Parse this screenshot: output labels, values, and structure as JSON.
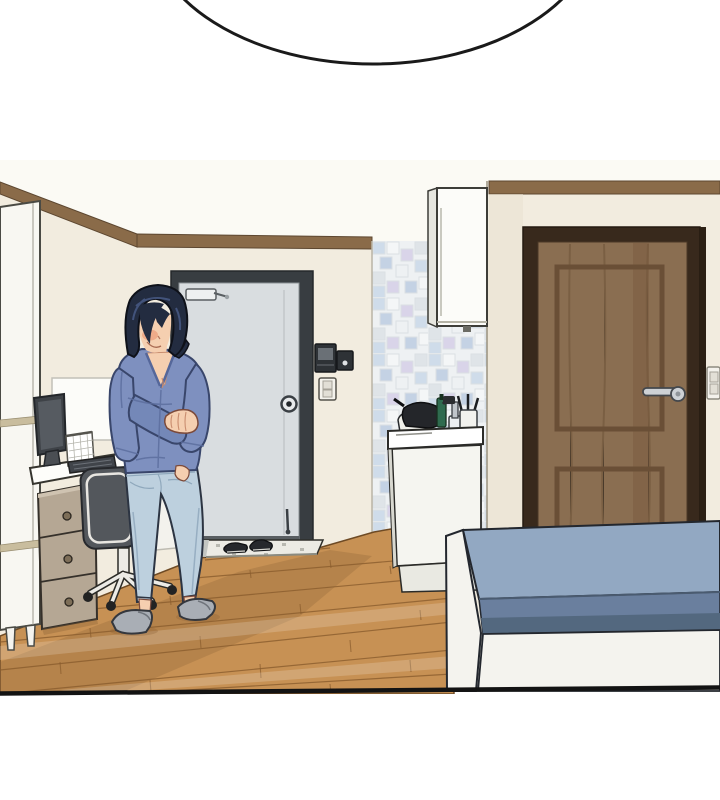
{
  "scene": {
    "kind": "webtoon-comic-panel",
    "speech_bubble": {
      "present": true,
      "text": ""
    },
    "objects": [
      "speech-bubble",
      "ceiling-trim",
      "left-wardrobe",
      "desk",
      "computer-monitor",
      "keyboard",
      "desk-calendar",
      "drawer-unit",
      "office-chair",
      "woman-figure",
      "entry-door",
      "door-closer",
      "door-peephole",
      "intercom-unit",
      "light-switch",
      "entry-step",
      "shoes",
      "tile-backsplash",
      "wall-cabinet",
      "sink-unit",
      "faucet",
      "dishes",
      "brown-door",
      "door-lever-handle",
      "right-light-switch",
      "bed",
      "mattress",
      "wood-floor",
      "panel-border"
    ]
  },
  "colors": {
    "page_bg": "#ffffff",
    "bubble_fill": "#ffffff",
    "bubble_stroke": "#1a1a1a",
    "ceiling": "#fbfaf4",
    "wall": "#f2ecdf",
    "wall_shade": "#e9e1d0",
    "trim_wood": "#8a6b49",
    "wardrobe_white": "#f8f7f2",
    "wardrobe_trim": "#c9bd9e",
    "panel_white": "#fcfcf9",
    "desk_white": "#fdfdfa",
    "monitor_dark": "#3e4247",
    "screen_gray": "#565b61",
    "keyboard_dark": "#40444a",
    "drawer_taupe": "#b5a794",
    "knob_brown": "#7d6e58",
    "chair_seat": "#53575c",
    "chair_frame": "#ecebe6",
    "caster_black": "#232323",
    "hair_dark": "#232c40",
    "hair_highlight": "#4a5d8a",
    "skin": "#f5cfb0",
    "blush": "#ec9f7c",
    "cardigan": "#7e90bf",
    "cardigan_shadow": "#7488b8",
    "cardigan_line": "#55679a",
    "jeans": "#bdd0de",
    "jeans_shadow": "#93abbf",
    "slipper_gray": "#a9aeb5",
    "gray_door": "#d9dde0",
    "gray_door_frame": "#383d41",
    "entry_step": "#ecebe4",
    "shoe_black": "#26282c",
    "tile_bg": "#eef1f3",
    "tile_blue": "#cfdcea",
    "tile_lavender": "#d9d4e9",
    "tile_gray": "#dfe4e8",
    "tile_deep": "#c4d2e4",
    "sink_white": "#f5f5f0",
    "counter_white": "#ffffff",
    "bottle_green": "#2f6b4f",
    "dish_dark": "#24262a",
    "faucet_gray": "#c0c5ca",
    "brown_door": "#8a6e51",
    "brown_door_frame": "#38291c",
    "brown_door_panel": "#6a4f36",
    "handle_silver": "#cdd1d5",
    "mattress_top": "#92a8c2",
    "mattress_front": "#6a7f9e",
    "mattress_dark": "#53687f",
    "bed_white": "#f4f3ee",
    "floor": "#c79154",
    "floor_shadow": "#8a6136",
    "floor_line": "#7d5426",
    "intercom_dark": "#2e3236",
    "intercom_screen": "#6a7076",
    "switch_white": "#f4f2ec",
    "outline": "#141414"
  }
}
